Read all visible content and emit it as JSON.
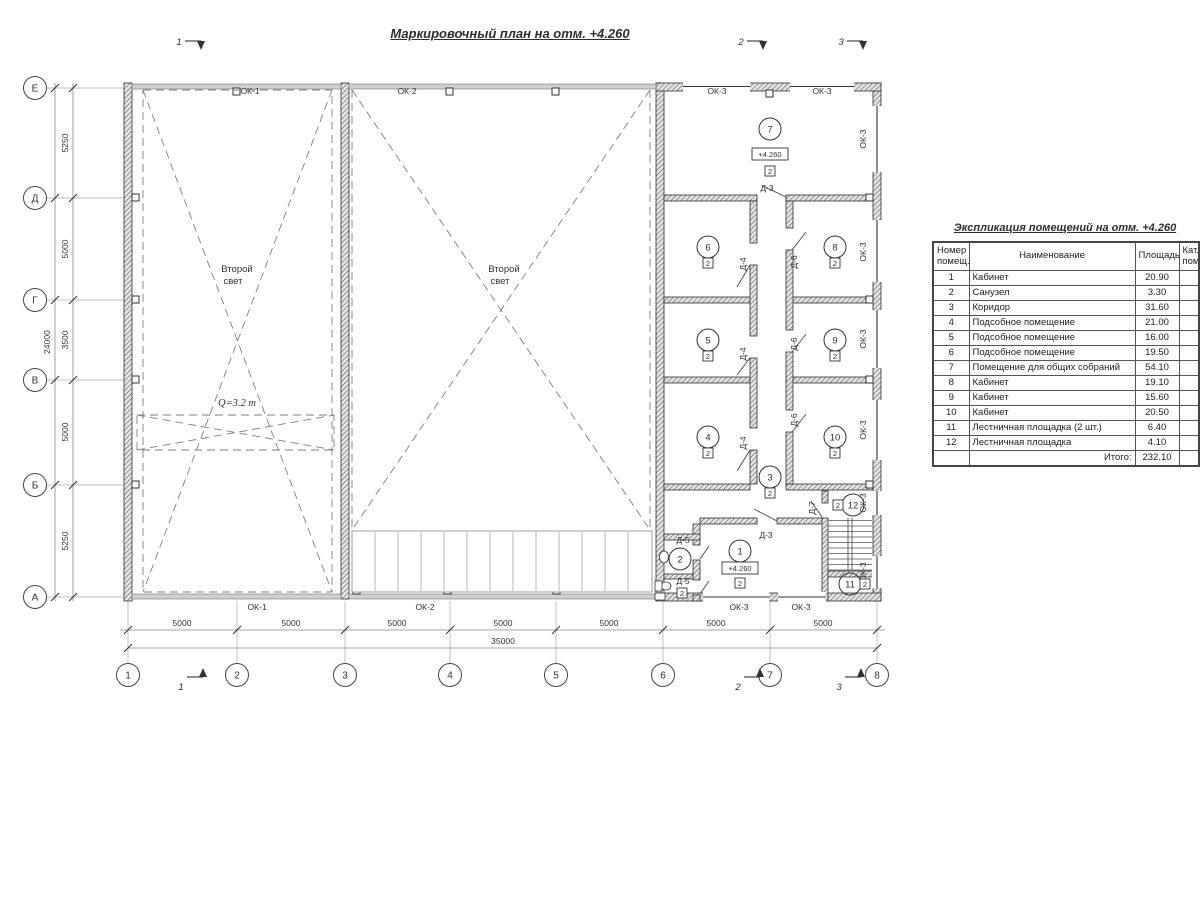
{
  "title": "Маркировочный план на отм. +4.260",
  "marks": {
    "m1": "1",
    "m2": "2",
    "m3": "3"
  },
  "axis_rows": [
    "Е",
    "Д",
    "Г",
    "В",
    "Б",
    "А"
  ],
  "axis_cols": [
    "1",
    "2",
    "3",
    "4",
    "5",
    "6",
    "7",
    "8"
  ],
  "dims_v": [
    "5250",
    "5000",
    "3500",
    "5000",
    "5250"
  ],
  "dim_v_total": "24000",
  "dim_h": "5000",
  "dim_h_total": "35000",
  "win": {
    "ok1": "ОК-1",
    "ok2": "ОК-2",
    "ok3": "ОК-3"
  },
  "door": {
    "d3": "Д-3",
    "d4": "Д-4",
    "d5": "Д-5",
    "d6": "Д-6",
    "d7": "Д-7"
  },
  "rooms": [
    "1",
    "2",
    "3",
    "4",
    "5",
    "6",
    "7",
    "8",
    "9",
    "10",
    "11",
    "12"
  ],
  "cat": "2",
  "elev": "+4.260",
  "second_light": {
    "l1": "Второй",
    "l2": "свет"
  },
  "crane_capacity": "Q=3.2 т",
  "table": {
    "title": "Экспликация помещений на отм. +4.260",
    "col_headers": [
      "Номер\nпомещ.",
      "Наименование",
      "Площадь",
      "Кат.\nпом."
    ],
    "rows": [
      [
        "1",
        "Кабинет",
        "20.90",
        ""
      ],
      [
        "2",
        "Санузел",
        "3.30",
        ""
      ],
      [
        "3",
        "Коридор",
        "31.60",
        ""
      ],
      [
        "4",
        "Подсобное помещение",
        "21.00",
        ""
      ],
      [
        "5",
        "Подсобное помещение",
        "16.00",
        ""
      ],
      [
        "6",
        "Подсобное помещение",
        "19.50",
        ""
      ],
      [
        "7",
        "Помещение для общих собраний",
        "54.10",
        ""
      ],
      [
        "8",
        "Кабинет",
        "19.10",
        ""
      ],
      [
        "9",
        "Кабинет",
        "15.60",
        ""
      ],
      [
        "10",
        "Кабинет",
        "20.50",
        ""
      ],
      [
        "11",
        "Лестничная площадка (2 шт.)",
        "6.40",
        ""
      ],
      [
        "12",
        "Лестничная площадка",
        "4.10",
        ""
      ]
    ],
    "total_label": "Итого:",
    "total_value": "232.10"
  }
}
